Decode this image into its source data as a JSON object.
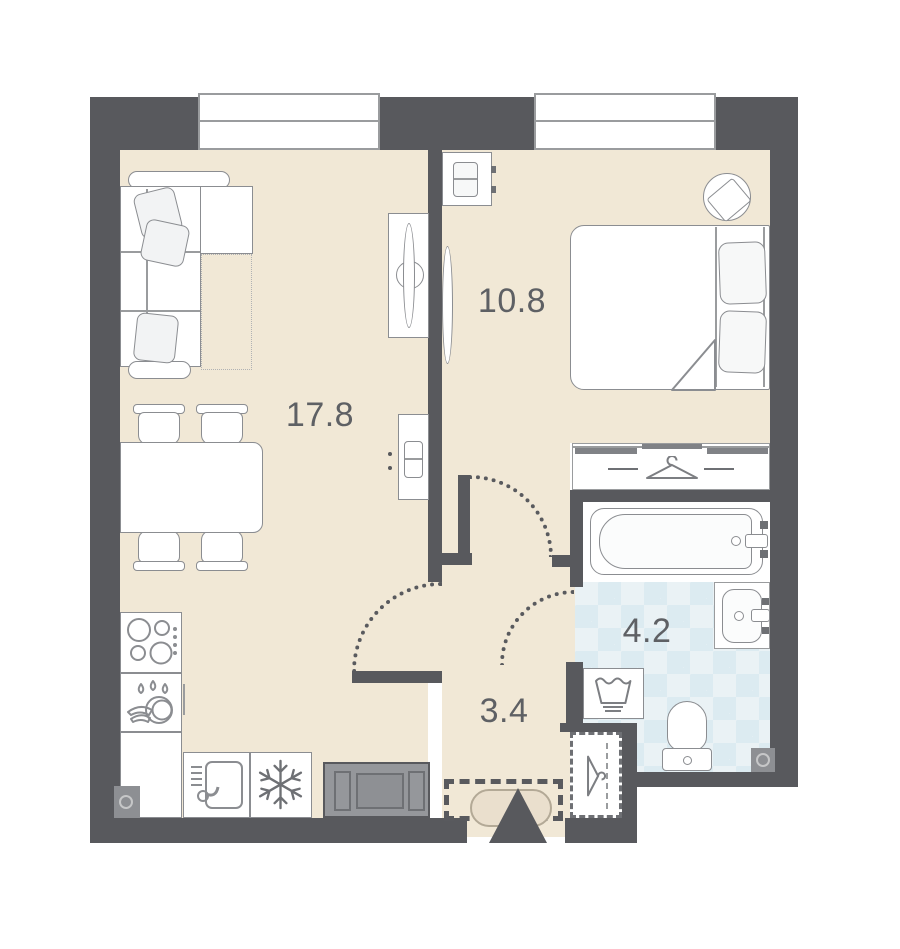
{
  "plan": {
    "type": "apartment-floor-plan",
    "rooms": {
      "living_kitchen": {
        "label": "17.8"
      },
      "bedroom": {
        "label": "10.8"
      },
      "bathroom": {
        "label": "4.2"
      },
      "hallway": {
        "label": "3.4"
      }
    },
    "windows": {
      "count": 2
    },
    "furniture": {
      "living_kitchen": [
        "corner-sofa",
        "pillows-x3",
        "tv-stand",
        "tv",
        "sideboard",
        "dining-table",
        "chairs-x4",
        "cooktop",
        "dish-rack",
        "kitchen-counter",
        "kitchen-sink",
        "fridge",
        "gray-cabinet",
        "ventilation-shaft"
      ],
      "bedroom": [
        "double-bed",
        "pillows-x2",
        "blanket-fold",
        "nightstand",
        "wall-tv",
        "stool-with-tray",
        "sliding-wardrobe",
        "hanger-icon"
      ],
      "bathroom": [
        "bathtub",
        "washbasin",
        "washing-machine",
        "toilet",
        "ventilation-shaft"
      ],
      "hallway": [
        "entrance-arrow",
        "doormat",
        "storage-dashed-zone",
        "coat-closet",
        "hanger-icon"
      ],
      "doors": [
        "living-door-swing",
        "bedroom-door-swing",
        "bathroom-door-swing"
      ]
    }
  },
  "colors": {
    "wall": "#58595d",
    "floor": "#f1e8d6",
    "stroke": "#8b8d91",
    "strokeDark": "#6e7074",
    "strokeLight": "#9a9c9e",
    "fill": "#ffffff",
    "fillSoft": "#f2f3f4",
    "tile": "#eaf2f5",
    "tileAlt": "#dcebf1",
    "grayFurn": "#95979b",
    "mat": "#eadfcd",
    "matBorder": "#b3a996",
    "label": "#5e6064",
    "dotted": "#595a5e"
  }
}
